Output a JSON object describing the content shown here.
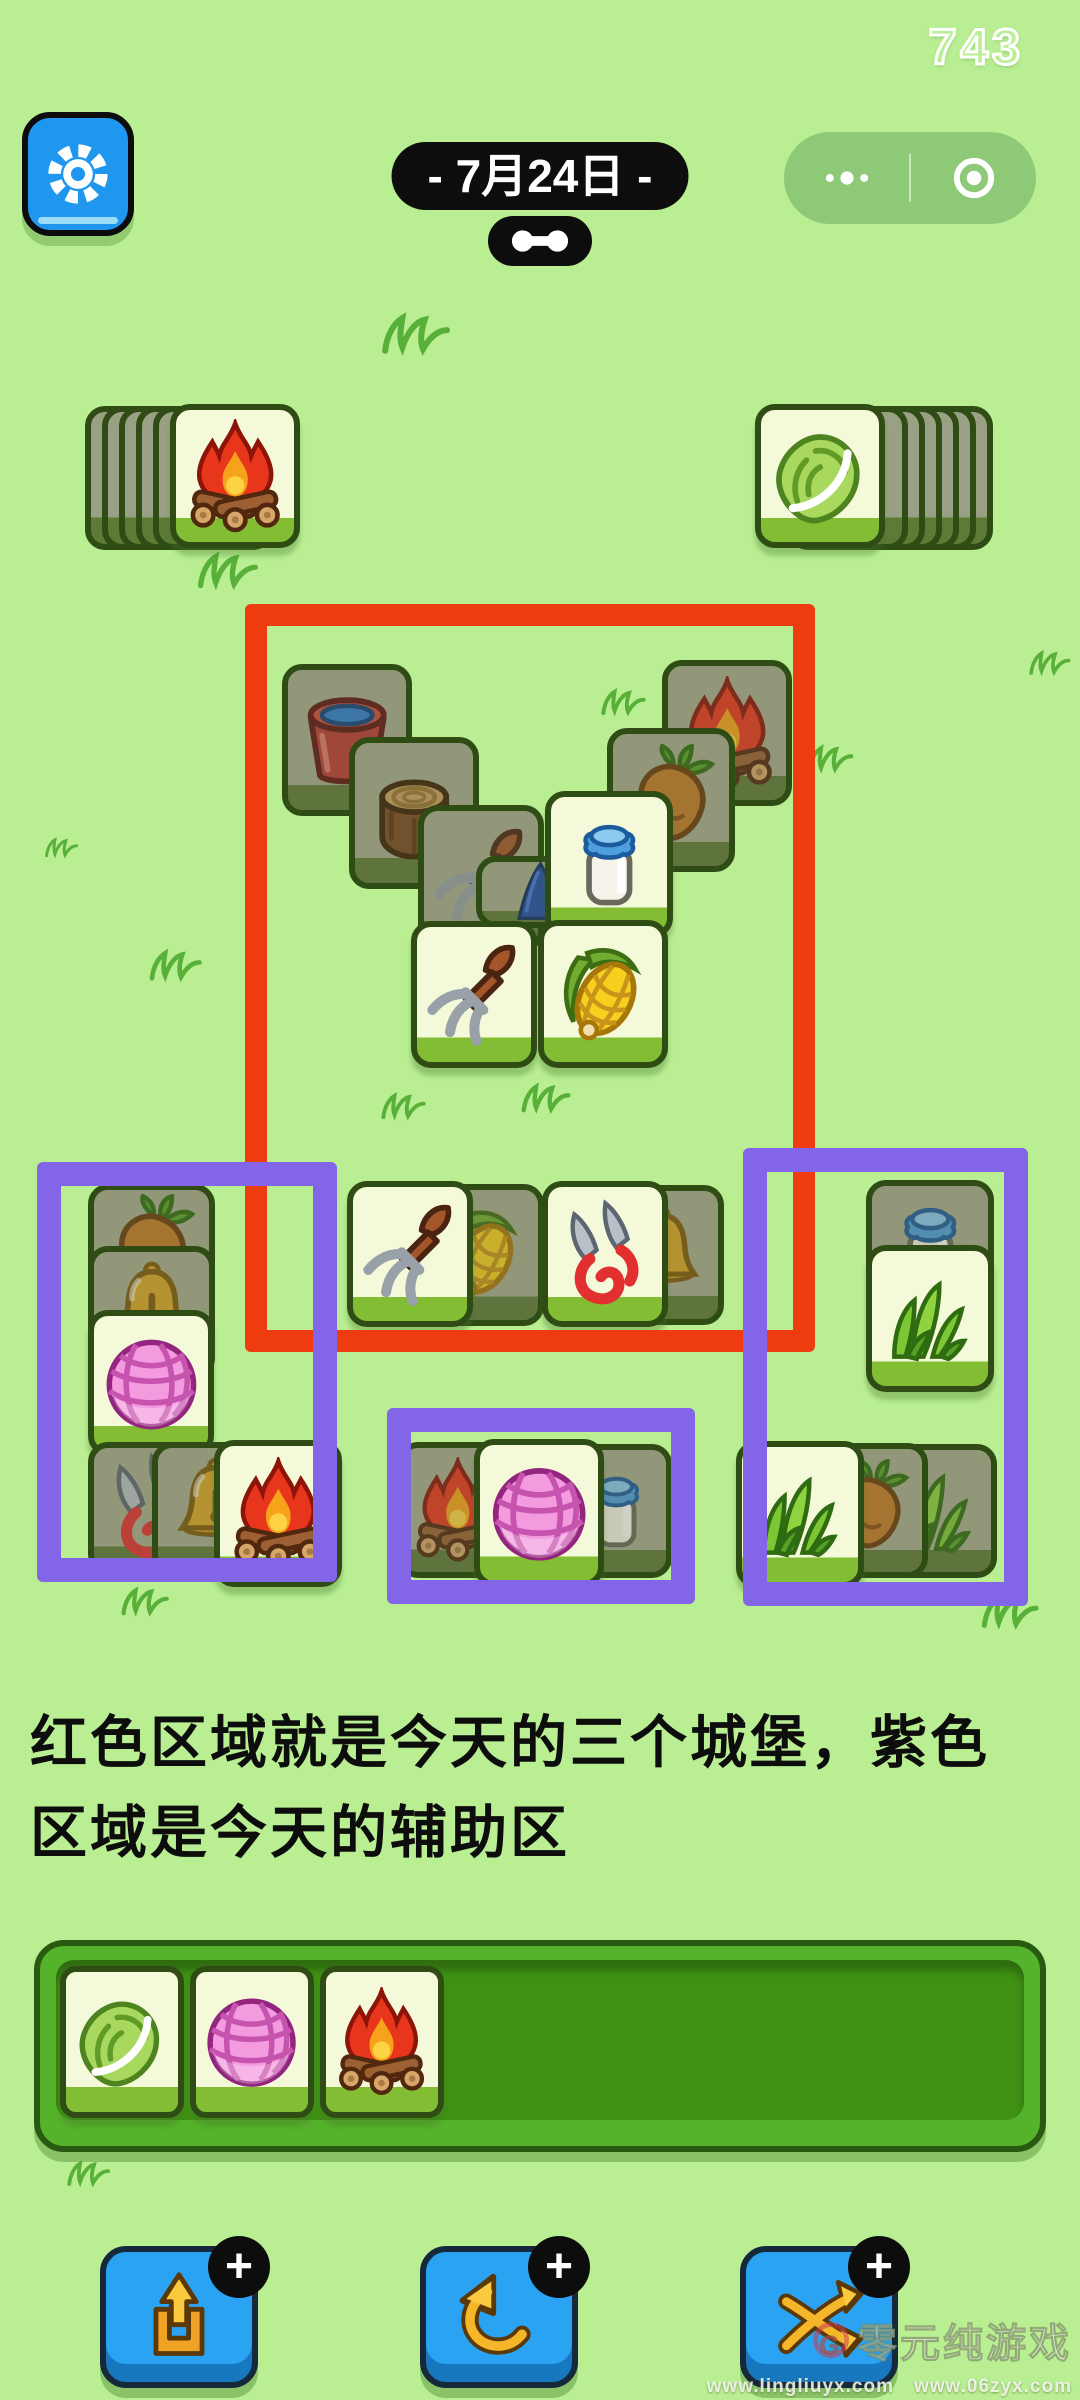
{
  "hud": {
    "score": "743",
    "date_label": "- 7月24日 -"
  },
  "caption": {
    "line1": "红色区域就是今天的三个城堡，紫色",
    "line2": "区域是今天的辅助区"
  },
  "colors": {
    "background": "#b9ee93",
    "castle_outline": "#ee3b10",
    "helper_outline": "#8365e8",
    "tile_face": "#f4f9da",
    "tile_face_edge": "#82bd33",
    "tile_dim": "#a8ac90",
    "button_blue": "#2aa3f2",
    "settings_blue": "#1f97ef",
    "tray_green": "#55b22b"
  },
  "zones": [
    {
      "name": "castle-zone-red",
      "color": "#ee3b10",
      "x": 245,
      "y": 604,
      "w": 570,
      "h": 748,
      "stroke": 22
    },
    {
      "name": "helper-zone-left",
      "color": "#8365e8",
      "x": 37,
      "y": 1162,
      "w": 300,
      "h": 420,
      "stroke": 24
    },
    {
      "name": "helper-zone-middle",
      "color": "#8365e8",
      "x": 387,
      "y": 1408,
      "w": 308,
      "h": 196,
      "stroke": 24
    },
    {
      "name": "helper-zone-right",
      "color": "#8365e8",
      "x": 743,
      "y": 1148,
      "w": 285,
      "h": 458,
      "stroke": 24
    }
  ],
  "stacks": {
    "left": {
      "icon": "fire",
      "y": 406,
      "backs_x": [
        85,
        102,
        119,
        136,
        153
      ],
      "face_x": 170,
      "w": 130,
      "h": 144,
      "back_w": 120
    },
    "right": {
      "icon": "cabbage",
      "y": 406,
      "backs_x": [
        873,
        856,
        839,
        822,
        805,
        788
      ],
      "face_x": 755,
      "w": 130,
      "h": 144,
      "back_w": 120
    }
  },
  "tiles": [
    {
      "icon": "bucket",
      "x": 282,
      "y": 664,
      "w": 130,
      "h": 152,
      "state": "dim"
    },
    {
      "icon": "fire",
      "x": 662,
      "y": 660,
      "w": 130,
      "h": 146,
      "state": "dim"
    },
    {
      "icon": "stump",
      "x": 349,
      "y": 737,
      "w": 130,
      "h": 152,
      "state": "dim"
    },
    {
      "icon": "carrot",
      "x": 607,
      "y": 728,
      "w": 128,
      "h": 144,
      "state": "dim"
    },
    {
      "icon": "pitchfork",
      "x": 418,
      "y": 805,
      "w": 126,
      "h": 146,
      "state": "dim"
    },
    {
      "icon": "blue-item",
      "x": 476,
      "y": 856,
      "w": 112,
      "h": 72,
      "state": "dim"
    },
    {
      "icon": "milk",
      "x": 545,
      "y": 791,
      "w": 128,
      "h": 147,
      "state": "bright"
    },
    {
      "icon": "pitchfork",
      "x": 411,
      "y": 921,
      "w": 126,
      "h": 147,
      "state": "bright"
    },
    {
      "icon": "corn",
      "x": 538,
      "y": 920,
      "w": 130,
      "h": 148,
      "state": "bright"
    },
    {
      "icon": "corn",
      "x": 420,
      "y": 1184,
      "w": 124,
      "h": 142,
      "state": "dim"
    },
    {
      "icon": "pitchfork",
      "x": 347,
      "y": 1181,
      "w": 126,
      "h": 146,
      "state": "bright"
    },
    {
      "icon": "bell",
      "x": 600,
      "y": 1185,
      "w": 124,
      "h": 140,
      "state": "dim"
    },
    {
      "icon": "shears",
      "x": 542,
      "y": 1181,
      "w": 126,
      "h": 146,
      "state": "bright"
    },
    {
      "icon": "carrot",
      "x": 88,
      "y": 1184,
      "w": 127,
      "h": 132,
      "state": "dim"
    },
    {
      "icon": "bell",
      "x": 88,
      "y": 1246,
      "w": 127,
      "h": 132,
      "state": "dim"
    },
    {
      "icon": "yarn",
      "x": 88,
      "y": 1310,
      "w": 126,
      "h": 146,
      "state": "bright"
    },
    {
      "icon": "shears",
      "x": 88,
      "y": 1442,
      "w": 127,
      "h": 132,
      "state": "dim"
    },
    {
      "icon": "bell",
      "x": 152,
      "y": 1442,
      "w": 127,
      "h": 132,
      "state": "dim"
    },
    {
      "icon": "fire",
      "x": 214,
      "y": 1440,
      "w": 128,
      "h": 147,
      "state": "bright"
    },
    {
      "icon": "fire",
      "x": 398,
      "y": 1442,
      "w": 120,
      "h": 136,
      "state": "dim"
    },
    {
      "icon": "milk",
      "x": 560,
      "y": 1444,
      "w": 112,
      "h": 134,
      "state": "dim"
    },
    {
      "icon": "yarn",
      "x": 474,
      "y": 1439,
      "w": 130,
      "h": 148,
      "state": "bright"
    },
    {
      "icon": "milk",
      "x": 866,
      "y": 1180,
      "w": 128,
      "h": 134,
      "state": "dim"
    },
    {
      "icon": "grass",
      "x": 866,
      "y": 1245,
      "w": 128,
      "h": 147,
      "state": "bright"
    },
    {
      "icon": "grass",
      "x": 870,
      "y": 1444,
      "w": 127,
      "h": 134,
      "state": "dim"
    },
    {
      "icon": "carrot",
      "x": 810,
      "y": 1443,
      "w": 118,
      "h": 135,
      "state": "dim"
    },
    {
      "icon": "grass",
      "x": 736,
      "y": 1441,
      "w": 128,
      "h": 147,
      "state": "bright"
    }
  ],
  "tray": {
    "tiles": [
      "cabbage",
      "yarn",
      "fire"
    ],
    "x0": 60,
    "y0": 1966,
    "tile_w": 124,
    "tile_h": 152,
    "gap": 6
  },
  "buttons": [
    {
      "name": "remove-tiles-button",
      "icon": "out",
      "badge": "+",
      "x": 100
    },
    {
      "name": "undo-button",
      "icon": "undo",
      "badge": "+",
      "x": 420
    },
    {
      "name": "shuffle-button",
      "icon": "shuffle",
      "badge": "+",
      "x": 740
    }
  ],
  "watermark": {
    "logo": "G",
    "title": "零元纯游戏",
    "urls": "www.lingliuyx.com　www.06zyx.com"
  },
  "decor": {
    "grass": [
      {
        "x": 380,
        "y": 306,
        "s": 86
      },
      {
        "x": 196,
        "y": 546,
        "s": 76
      },
      {
        "x": 44,
        "y": 834,
        "s": 42
      },
      {
        "x": 148,
        "y": 944,
        "s": 66
      },
      {
        "x": 600,
        "y": 684,
        "s": 56
      },
      {
        "x": 806,
        "y": 740,
        "s": 58
      },
      {
        "x": 380,
        "y": 1088,
        "s": 56
      },
      {
        "x": 520,
        "y": 1078,
        "s": 62
      },
      {
        "x": 1028,
        "y": 646,
        "s": 52
      },
      {
        "x": 980,
        "y": 1588,
        "s": 72
      },
      {
        "x": 120,
        "y": 1582,
        "s": 60
      },
      {
        "x": 66,
        "y": 2156,
        "s": 54
      }
    ]
  }
}
